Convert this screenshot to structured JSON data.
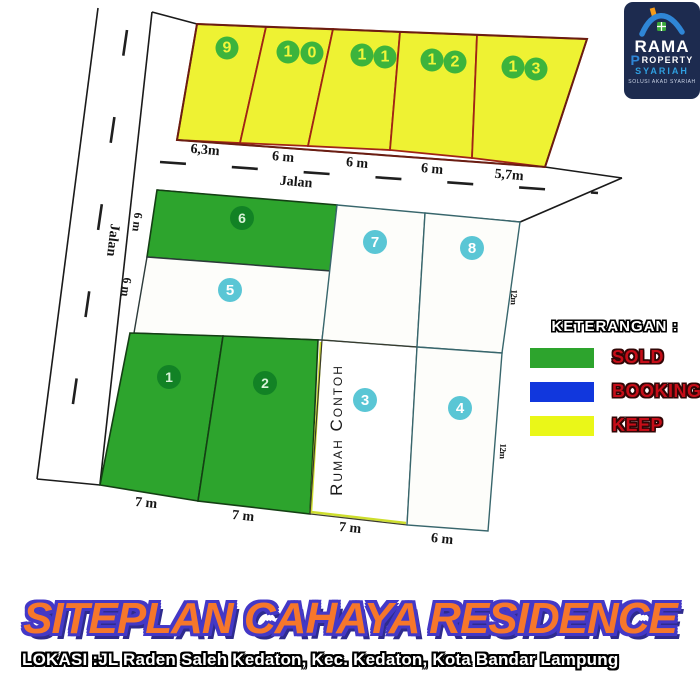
{
  "logo": {
    "brand": "RAMA",
    "property_initial": "P",
    "property_rest": "ROPERTY",
    "syariah": "SYARIAH",
    "tagline": "SOLUSI AKAD SYARIAH"
  },
  "plan": {
    "road_label_left": "Jalan",
    "road_label_top": "Jalan",
    "rumah_contoh_label": "Rumah Contoh",
    "lots": [
      {
        "number": "1",
        "status": "SOLD",
        "width": "7 m"
      },
      {
        "number": "2",
        "status": "SOLD",
        "width": "7 m"
      },
      {
        "number": "3",
        "width": "7 m",
        "note": "Rumah Contoh"
      },
      {
        "number": "4",
        "width": "6 m",
        "depth": "12m"
      },
      {
        "number": "5",
        "depth": "6 m"
      },
      {
        "number": "6",
        "status": "SOLD",
        "depth": "6 m"
      },
      {
        "number": "7"
      },
      {
        "number": "8",
        "depth": "12m"
      },
      {
        "number": "9",
        "status": "KEEP",
        "width": "6,3m"
      },
      {
        "number": "10",
        "status": "KEEP",
        "width": "6 m",
        "digits": [
          "1",
          "0"
        ]
      },
      {
        "number": "11",
        "status": "KEEP",
        "width": "6 m",
        "digits": [
          "1",
          "1"
        ]
      },
      {
        "number": "12",
        "status": "KEEP",
        "width": "6 m",
        "digits": [
          "1",
          "2"
        ]
      },
      {
        "number": "13",
        "status": "KEEP",
        "width": "5,7m",
        "digits": [
          "1",
          "3"
        ]
      }
    ]
  },
  "legend": {
    "title": "KETERANGAN :",
    "items": [
      {
        "label": "SOLD",
        "color": "#2da42d"
      },
      {
        "label": "BOOKING",
        "color": "#1137dd"
      },
      {
        "label": "KEEP",
        "color": "#eaf718"
      }
    ]
  },
  "footer": {
    "title": "SITEPLAN CAHAYA RESIDENCE",
    "location": "LOKASI :JL Raden Saleh Kedaton, Kec. Kedaton, Kota Bandar Lampung"
  },
  "colors": {
    "sold_green": "#2da42d",
    "keep_yellow": "#eef233",
    "booking_blue": "#1137dd",
    "badge_cyan": "#5ac6d5",
    "badge_dark_green": "#128225",
    "badge_keep_green": "#3cb43c",
    "lot_border_red": "#a02415",
    "title_orange": "#f6772b",
    "title_outline_purple": "#4438c6",
    "legend_label_red": "#c60d18",
    "logo_navy": "#1d2b4f",
    "logo_blue": "#2f86d6",
    "logo_orange": "#f59b19"
  }
}
